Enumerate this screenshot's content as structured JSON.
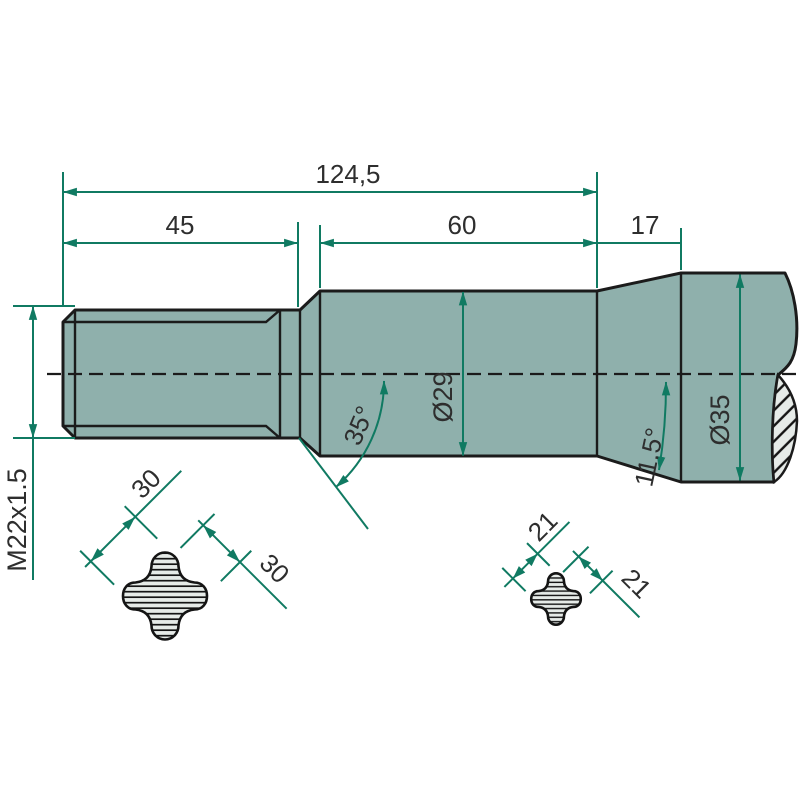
{
  "drawing": {
    "type": "technical-drawing",
    "subject": "rotary-tiller-tine-shaft",
    "colors": {
      "part_fill": "#8fb0ac",
      "outline": "#1b1b1b",
      "dimension_lines": "#107a62",
      "section_fill": "#e6ebe8",
      "label_text": "#2e2e2e",
      "background": "#ffffff"
    },
    "dimensions": {
      "overall_length": "124,5",
      "thread_length": "45",
      "shaft_length": "60",
      "end_length": "17",
      "thread_spec": "M22x1.5",
      "shaft_diameter": "Ø29",
      "end_diameter": "Ø35",
      "chamfer_angle": "35°",
      "end_taper_angle": "11.5°",
      "section_a_dim1": "30",
      "section_a_dim2": "30",
      "section_b_dim1": "21",
      "section_b_dim2": "21"
    }
  }
}
